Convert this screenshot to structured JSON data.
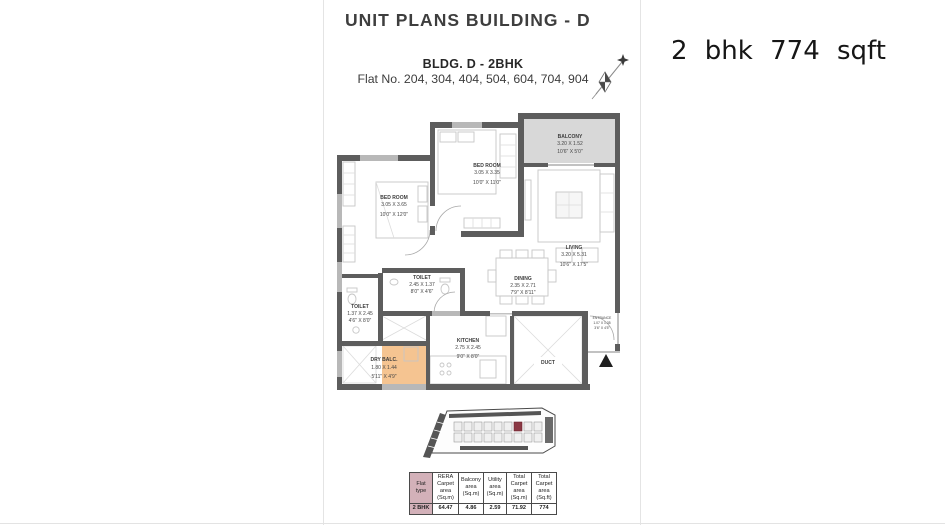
{
  "header": {
    "title": "UNIT PLANS BUILDING - D"
  },
  "plan": {
    "subtitle": "BLDG. D - 2BHK",
    "flat_numbers": "Flat No. 204, 304, 404, 504, 604, 704, 904",
    "rooms": [
      {
        "name": "BALCONY",
        "dim_m": "3.20 X 1.52",
        "dim_ft": "10'6\" X 5'0\""
      },
      {
        "name": "BED ROOM",
        "dim_m": "3.05 X 3.35",
        "dim_ft": "10'0\" X 11'0\""
      },
      {
        "name": "BED ROOM",
        "dim_m": "3.05 X 3.65",
        "dim_ft": "10'0\" X 12'0\""
      },
      {
        "name": "LIVING",
        "dim_m": "3.20 X 5.31",
        "dim_ft": "10'6\" X 17'5\""
      },
      {
        "name": "DINING",
        "dim_m": "2.35 X 2.71",
        "dim_ft": "7'9\" X 8'11\""
      },
      {
        "name": "TOILET",
        "dim_m": "2.45 X 1.37",
        "dim_ft": "8'0\" X 4'6\""
      },
      {
        "name": "TOILET",
        "dim_m": "1.37 X 2.45",
        "dim_ft": "4'6\" X 8'0\""
      },
      {
        "name": "KITCHEN",
        "dim_m": "2.75 X 2.45",
        "dim_ft": "9'0\" X 8'0\""
      },
      {
        "name": "DRY BALC.",
        "dim_m": "1.80 X 1.44",
        "dim_ft": "5'11\" X 4'9\""
      },
      {
        "name": "ENTRANCE",
        "dim_m": "1.07 X 1.35",
        "dim_ft": "3'6\" X 4'5\""
      },
      {
        "name": "DUCT"
      }
    ]
  },
  "annotation": {
    "text": "2 bhk 774 sqft"
  },
  "area_table": {
    "headers": [
      "Flat type",
      "RERA Carpet area (Sq.m)",
      "Balcony area (Sq.m)",
      "Utility area (Sq.m)",
      "Total Carpet area (Sq.m)",
      "Total Carpet area (Sq.ft)"
    ],
    "row": [
      "2 BHK",
      "64.47",
      "4.86",
      "2.59",
      "71.92",
      "774"
    ]
  },
  "colors": {
    "wall": "#5d5d5d",
    "balcony_fill": "#d8d8d8",
    "dry_balcony_fill": "#f5c491",
    "flat_column": "#d3b1b9",
    "keyplan_highlight": "#8b3844"
  }
}
